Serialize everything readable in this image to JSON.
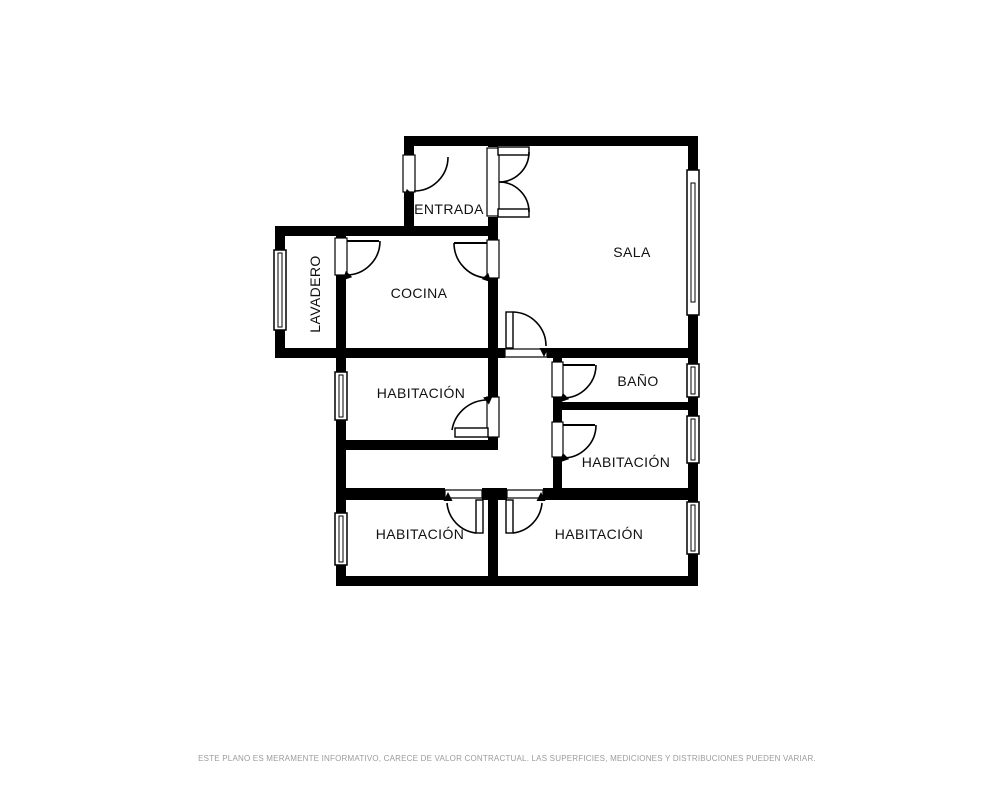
{
  "plan": {
    "background_color": "#ffffff",
    "wall_color": "#000000",
    "label_color": "#111111",
    "rooms": [
      {
        "name": "entrada",
        "label": "ENTRADA"
      },
      {
        "name": "sala",
        "label": "SALA"
      },
      {
        "name": "cocina",
        "label": "COCINA"
      },
      {
        "name": "lavadero",
        "label": "LAVADERO"
      },
      {
        "name": "habitacion-centro-izquierda",
        "label": "HABITACIÓN"
      },
      {
        "name": "bano",
        "label": "BAÑO"
      },
      {
        "name": "habitacion-centro-derecha",
        "label": "HABITACIÓN"
      },
      {
        "name": "habitacion-inferior-izquierda",
        "label": "HABITACIÓN"
      },
      {
        "name": "habitacion-inferior-derecha",
        "label": "HABITACIÓN"
      }
    ]
  },
  "footer": {
    "disclaimer": "ESTE PLANO ES MERAMENTE INFORMATIVO, CARECE DE VALOR CONTRACTUAL. LAS SUPERFICIES, MEDICIONES Y DISTRIBUCIONES PUEDEN VARIAR.",
    "text_color": "#9b9b9b"
  }
}
